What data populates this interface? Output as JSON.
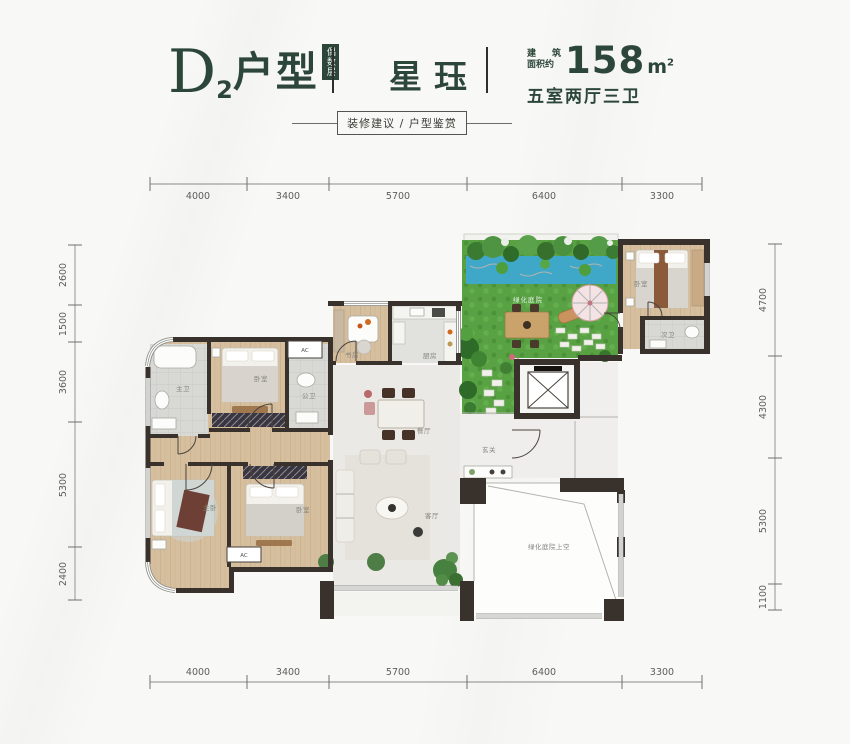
{
  "header": {
    "title_letter": "D",
    "title_index": "2",
    "title_text": "户型",
    "badge": "偶数层",
    "name": "星珏",
    "area_label_line1_a": "建",
    "area_label_line1_b": "筑",
    "area_label_line2": "面积约",
    "area_value": "158",
    "area_unit": "m",
    "area_unit_sup": "2",
    "spec": "五室两厅三卫",
    "ribbon": "装修建议 / 户型鉴赏",
    "accent_color": "#2c4639"
  },
  "dimensions": {
    "top": [
      "4000",
      "3400",
      "5700",
      "6400",
      "3300"
    ],
    "bottom": [
      "4000",
      "3400",
      "5700",
      "6400",
      "3300"
    ],
    "left": [
      "2600",
      "1500",
      "3600",
      "5300",
      "2400"
    ],
    "right": [
      "4700",
      "4300",
      "5300",
      "1100"
    ]
  },
  "rooms": {
    "master_bath": "主卫",
    "bedroom_top": "卧室",
    "public_bath": "公卫",
    "study": "书房",
    "kitchen": "厨房",
    "dining": "餐厅",
    "living": "客厅",
    "foyer": "玄关",
    "master_bedroom": "主卧",
    "bedroom_bottom": "卧室",
    "garden": "绿化庭院",
    "bedroom_right": "卧室",
    "second_bath": "次卫",
    "void_area": "绿化庭院上空",
    "ac1": "AC",
    "ac2": "AC"
  }
}
